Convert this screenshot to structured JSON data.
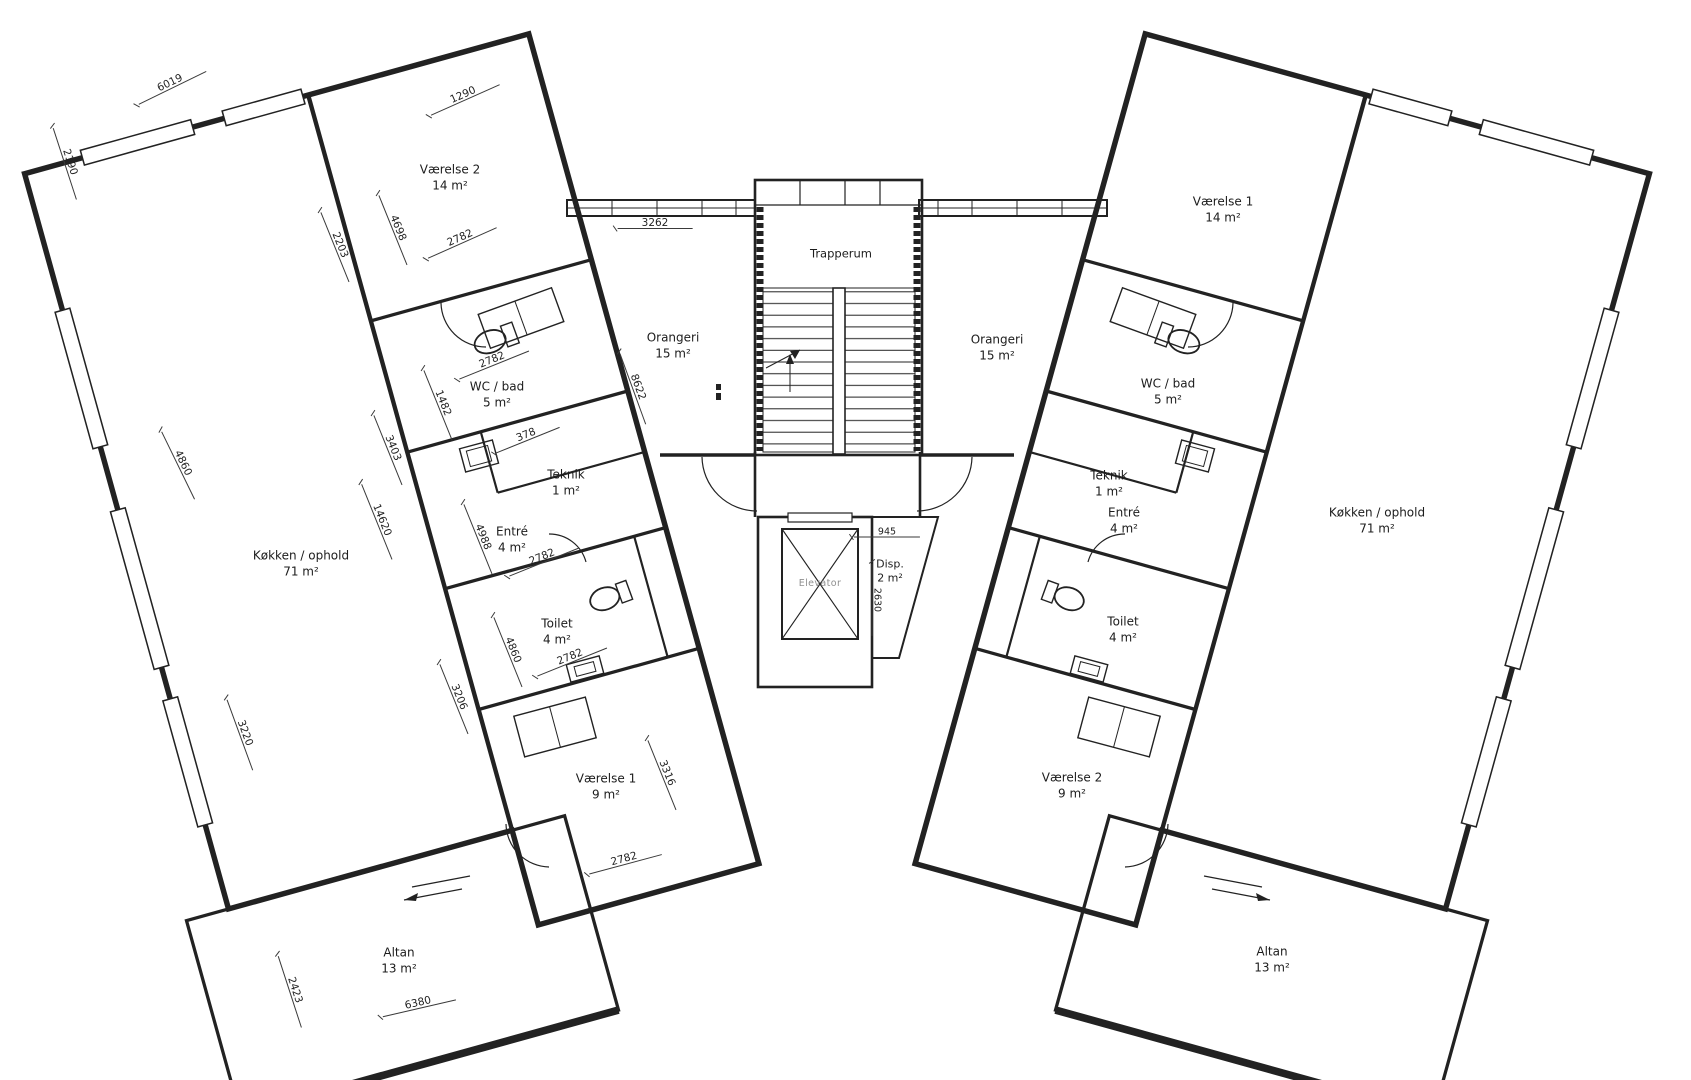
{
  "drawing": {
    "type": "floor-plan",
    "colors": {
      "ink": "#222222",
      "elevator_text": "#8f8f8f",
      "background": "#ffffff"
    }
  },
  "rooms": {
    "l_vaerelse2": {
      "name": "Værelse 2",
      "area": "14 m²"
    },
    "l_wc_bad": {
      "name": "WC / bad",
      "area": "5 m²"
    },
    "l_teknik": {
      "name": "Teknik",
      "area": "1 m²"
    },
    "l_entre": {
      "name": "Entré",
      "area": "4 m²"
    },
    "l_koekken": {
      "name": "Køkken / ophold",
      "area": "71 m²"
    },
    "l_toilet": {
      "name": "Toilet",
      "area": "4 m²"
    },
    "l_vaerelse1": {
      "name": "Værelse 1",
      "area": "9 m²"
    },
    "l_altan": {
      "name": "Altan",
      "area": "13 m²"
    },
    "l_orangeri": {
      "name": "Orangeri",
      "area": "15 m²"
    },
    "core_trapperum": {
      "name": "Trapperum"
    },
    "core_elevator": {
      "name": "Elevator"
    },
    "core_disp": {
      "name": "Disp.",
      "area": "2 m²"
    },
    "r_vaerelse1": {
      "name": "Værelse 1",
      "area": "14 m²"
    },
    "r_orangeri": {
      "name": "Orangeri",
      "area": "15 m²"
    },
    "r_wc_bad": {
      "name": "WC / bad",
      "area": "5 m²"
    },
    "r_teknik": {
      "name": "Teknik",
      "area": "1 m²"
    },
    "r_entre": {
      "name": "Entré",
      "area": "4 m²"
    },
    "r_toilet": {
      "name": "Toilet",
      "area": "4 m²"
    },
    "r_vaerelse2": {
      "name": "Værelse 2",
      "area": "9 m²"
    },
    "r_koekken": {
      "name": "Køkken / ophold",
      "area": "71 m²"
    },
    "r_altan": {
      "name": "Altan",
      "area": "13 m²"
    }
  },
  "dims": [
    "6019",
    "2190",
    "1290",
    "2782",
    "4698",
    "2203",
    "3262",
    "8622",
    "2782",
    "1482",
    "378",
    "4988",
    "2782",
    "4860",
    "3403",
    "14620",
    "4860",
    "2782",
    "3206",
    "3220",
    "3316",
    "2782",
    "2423",
    "6380",
    "945",
    "2630"
  ]
}
